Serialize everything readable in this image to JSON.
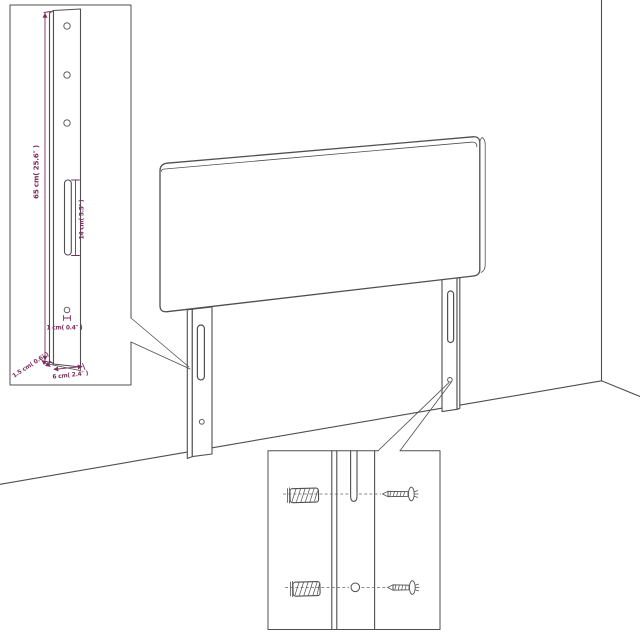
{
  "colors": {
    "background": "#ffffff",
    "outline": "#4f4f51",
    "dimension": "#7c2d5e"
  },
  "leg_inset": {
    "labels": {
      "leg_height": "65 cm( 25.6″ )",
      "slot_length": "14 cm( 5.5″ )",
      "hole_diameter": "1 cm( 0.4″ )",
      "leg_thickness": "1.5 cm( 0.6″ )",
      "leg_width": "6 cm( 2.4″ )"
    },
    "features": [
      "mounting-hole x3",
      "keyhole-slot",
      "screw-hole"
    ]
  },
  "hardware_inset": {
    "items": [
      {
        "icon": "wall-plug-icon",
        "row": "top"
      },
      {
        "icon": "screw-icon",
        "row": "top"
      },
      {
        "icon": "wall-plug-icon",
        "row": "bottom"
      },
      {
        "icon": "screw-icon",
        "row": "bottom"
      }
    ],
    "features": [
      "leg-slot-top",
      "leg-hole-bottom"
    ]
  },
  "scene": {
    "objects": [
      "headboard-panel",
      "left-mounting-leg",
      "right-mounting-leg",
      "wall-corner",
      "floor"
    ]
  }
}
